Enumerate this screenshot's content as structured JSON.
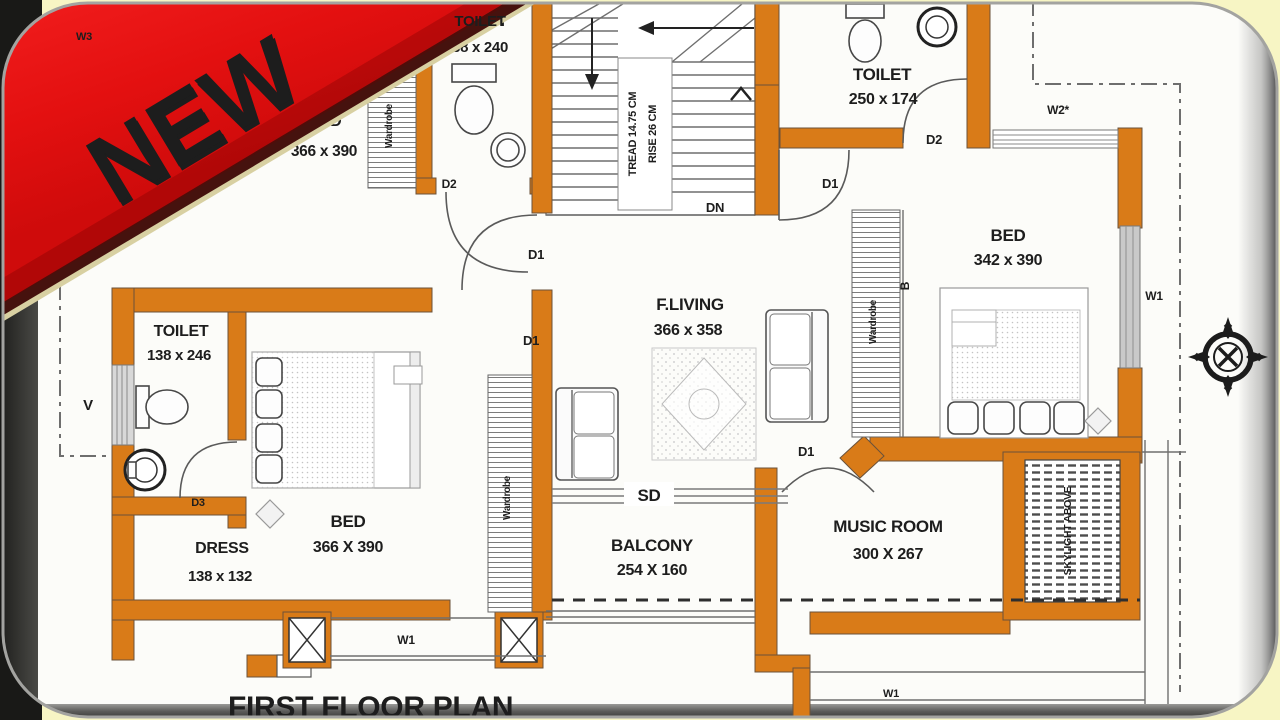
{
  "banner": {
    "label": "NEW",
    "color": "#e81414"
  },
  "plan_title": "FIRST FLOOR PLAN",
  "rooms": {
    "bed_top_left": {
      "name": "BED",
      "dims": "366 x 390"
    },
    "toilet_top": {
      "name": "TOILET",
      "dims": "138 x 240"
    },
    "toilet_top_right": {
      "name": "TOILET",
      "dims": "250 x 174"
    },
    "bed_right": {
      "name": "BED",
      "dims": "342 x 390"
    },
    "living": {
      "name": "F.LIVING",
      "dims": "366 x 358"
    },
    "toilet_left": {
      "name": "TOILET",
      "dims": "138 x 246"
    },
    "dress": {
      "name": "DRESS",
      "dims": "138 x 132"
    },
    "bed_left": {
      "name": "BED",
      "dims": "366 X 390"
    },
    "balcony": {
      "name": "BALCONY",
      "dims": "254 X 160"
    },
    "music_room": {
      "name": "MUSIC ROOM",
      "dims": "300 X 267"
    }
  },
  "stairs": {
    "tread_label": "TREAD 14.75 CM",
    "rise_label": "RISE 26 CM",
    "down_label": "DN"
  },
  "labels": {
    "door1": "D1",
    "door2": "D2",
    "door3": "D3",
    "sliding_door": "SD",
    "window1": "W1",
    "window2": "W2*",
    "window3": "W3",
    "vent": "V",
    "bath_marker": "B",
    "wardrobe": "Wardrobe",
    "skylight": "SKYLIGHT ABOVE"
  },
  "colors": {
    "wall": "#d97b18",
    "ribbon": "#e81414",
    "paper": "#fcfcf9",
    "outside": "#f7f5c4"
  }
}
